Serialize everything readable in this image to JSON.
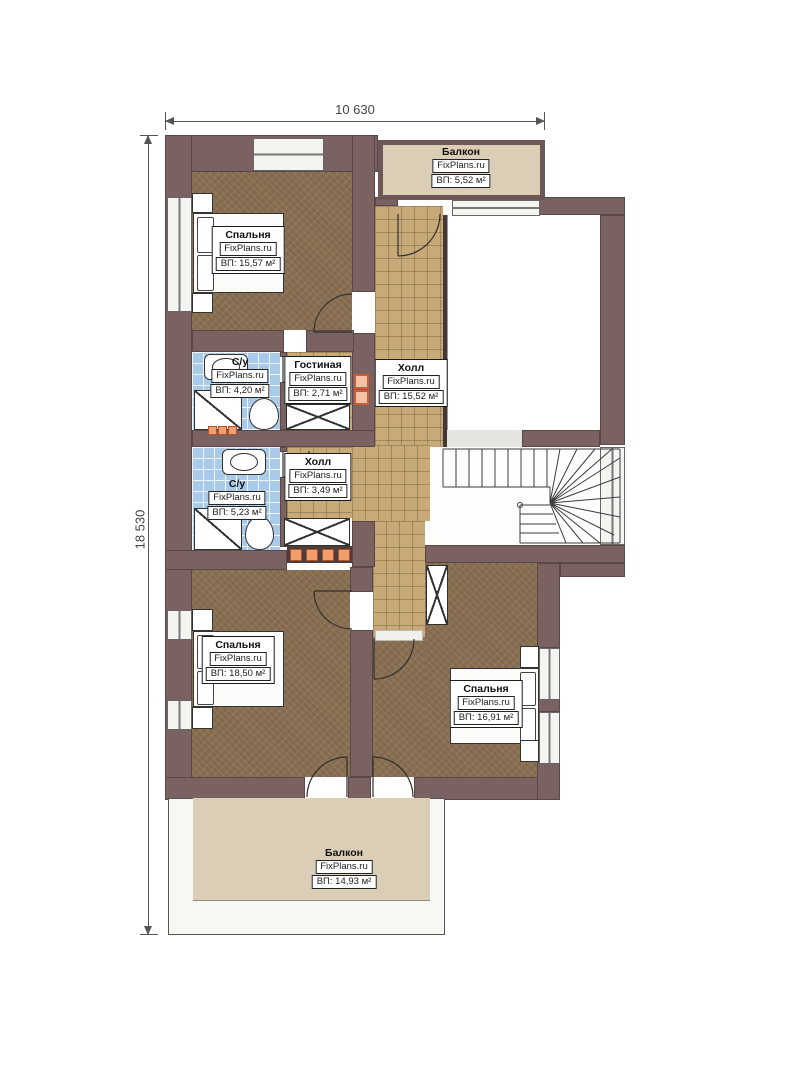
{
  "dimensions": {
    "width": "10 630",
    "height": "18 530"
  },
  "rooms": {
    "balcony_top": {
      "name": "Балкон",
      "brand": "FixPlans.ru",
      "area": "ВП: 5,52 м²"
    },
    "bedroom_top": {
      "name": "Спальня",
      "brand": "FixPlans.ru",
      "area": "ВП: 15,57 м²"
    },
    "bathroom_1": {
      "name": "С/у",
      "brand": "FixPlans.ru",
      "area": "ВП: 4,20 м²"
    },
    "living": {
      "name": "Гостиная",
      "brand": "FixPlans.ru",
      "area": "ВП: 2,71 м²"
    },
    "hall_main": {
      "name": "Холл",
      "brand": "FixPlans.ru",
      "area": "ВП: 15,52 м²"
    },
    "bathroom_2": {
      "name": "С/у",
      "brand": "FixPlans.ru",
      "area": "ВП: 5,23 м²"
    },
    "hall_small": {
      "name": "Холл",
      "brand": "FixPlans.ru",
      "area": "ВП: 3,49 м²"
    },
    "bedroom_left": {
      "name": "Спальня",
      "brand": "FixPlans.ru",
      "area": "ВП: 18,50 м²"
    },
    "bedroom_right": {
      "name": "Спальня",
      "brand": "FixPlans.ru",
      "area": "ВП: 16,91 м²"
    },
    "balcony_bottom": {
      "name": "Балкон",
      "brand": "FixPlans.ru",
      "area": "ВП: 14,93 м²"
    }
  },
  "colors": {
    "wall": "#7a6262",
    "bedroom_floor": "#8a7052",
    "tile_floor": "#c8aa79",
    "bathroom_tile": "#a9cbe9",
    "balcony_floor": "#dbceb7",
    "accent_orange": "#ef9e6d"
  }
}
